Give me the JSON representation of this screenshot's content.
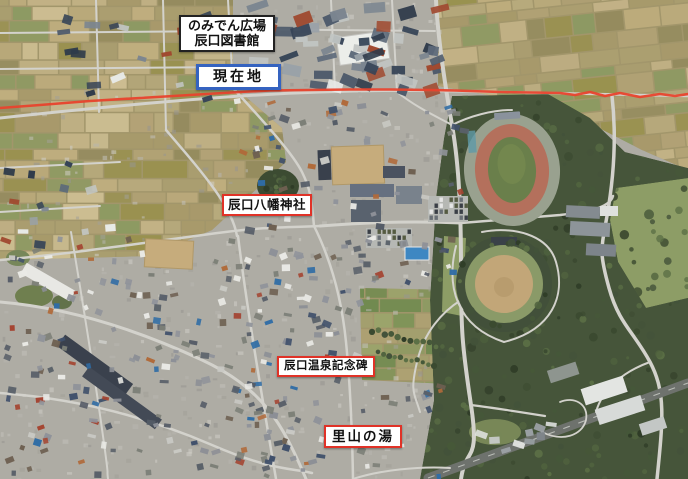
{
  "map_labels": {
    "nomiden_plaza_library": {
      "line1": "のみでん広場",
      "line2": "辰口図書館",
      "border_color": "#222222"
    },
    "current_location": {
      "text": "現在地",
      "border_color": "#3563c0"
    },
    "hachiman_shrine": {
      "text": "辰口八幡神社",
      "border_color": "#e03227"
    },
    "onsen_monument": {
      "text": "辰口温泉記念碑",
      "border_color": "#e03227"
    },
    "satoyama_no_yu": {
      "text": "里山の湯",
      "border_color": "#e03227"
    }
  },
  "route_line": {
    "color": "#e8432d"
  },
  "palette": {
    "urban_base": "#aeaca4",
    "road_gray": "#d3d2cc",
    "highway_dark": "#6e726d",
    "highway_median": "#b9bcb6",
    "track_red": "#b4705c",
    "infield_green": "#6a7f4b",
    "dirt_tan": "#c2a678",
    "pool_blue": "#3e87c2",
    "school_ground_tan": "#c6ac7c",
    "shrine_woods_green": "#3c4b32",
    "field_patches": [
      "#b3a376",
      "#a89a6b",
      "#c2b286",
      "#99914f",
      "#8c9a62",
      "#bfae7e",
      "#ccbd91",
      "#948b5e",
      "#ab9f70",
      "#b7aa7c"
    ],
    "field_green_patches": [
      "#8c9a62",
      "#7e9358",
      "#9aa56b",
      "#6f8a4f",
      "#a3a06e",
      "#b0a474"
    ],
    "forest_greens": [
      "#3b4a30",
      "#465839",
      "#2f3c27",
      "#51643f",
      "#5c7046",
      "#43523a"
    ],
    "urban_noise": [
      "#c3c1ba",
      "#a3a198",
      "#b8b6ae",
      "#98968f",
      "#cfcdc6"
    ],
    "house_colors": [
      "#90939a",
      "#90939a",
      "#8c8f96",
      "#e9e9e5",
      "#e9e9e5",
      "#596069",
      "#596069",
      "#545b66",
      "#7b7e76",
      "#7b7e76",
      "#a44431",
      "#b06a3a",
      "#40506b",
      "#6e6051",
      "#c9c9c4",
      "#2f6ca5"
    ],
    "industrial_colors": [
      "#4e5a6b",
      "#5d6a7a",
      "#e8eae8",
      "#9aa2a8",
      "#7b8590",
      "#a0492f",
      "#c2c6c4",
      "#364457",
      "#2e3a4a"
    ],
    "gray_colors": [
      "#9aa0a4",
      "#c9cccb",
      "#7f868b",
      "#e2e4e2"
    ],
    "car_colors": [
      "#3a3f46",
      "#6a7076",
      "#e6e6e6",
      "#555b42"
    ]
  }
}
